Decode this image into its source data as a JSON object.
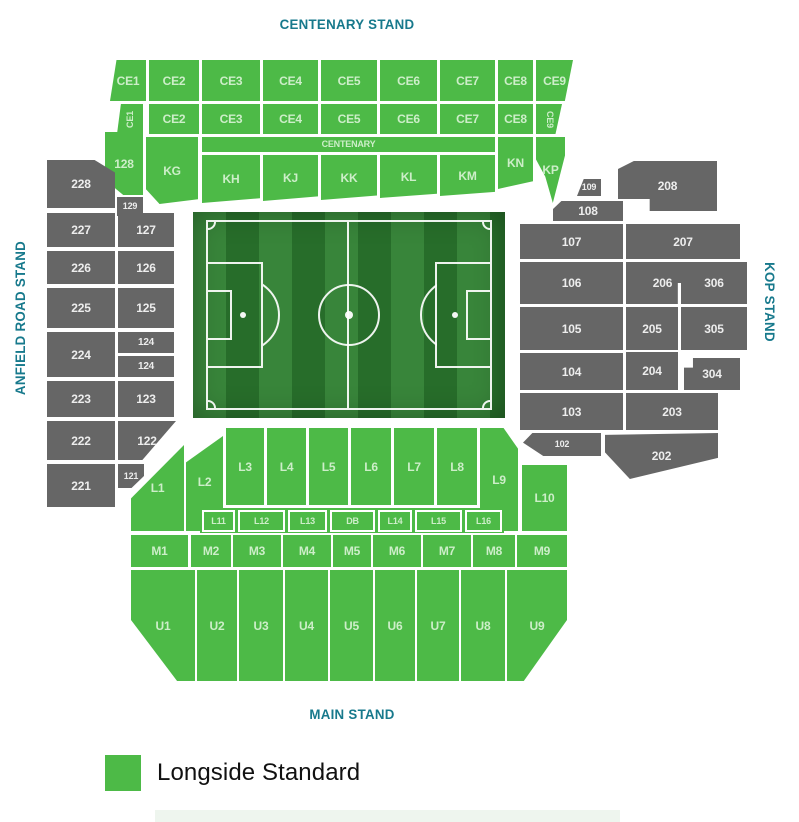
{
  "titles": {
    "centenary": "CENTENARY STAND",
    "anfield": "ANFIELD ROAD STAND",
    "kop": "KOP STAND",
    "main": "MAIN STAND"
  },
  "legend": {
    "label": "Longside Standard",
    "color": "#4dba47"
  },
  "colors": {
    "green": "#4dba47",
    "gray": "#666666",
    "teal": "#17798c",
    "pitch_light": "#38853a",
    "pitch_dark": "#276d2a",
    "line": "#ffffff"
  },
  "sections": [
    {
      "i": "CE1",
      "x": 110,
      "y": 60,
      "w": 36,
      "h": 41,
      "c": "18% 0,100% 0,100% 100%,0 100%"
    },
    {
      "i": "CE2",
      "x": 149,
      "y": 60,
      "w": 50,
      "h": 41
    },
    {
      "i": "CE3",
      "x": 202,
      "y": 60,
      "w": 58,
      "h": 41
    },
    {
      "i": "CE4",
      "x": 263,
      "y": 60,
      "w": 55,
      "h": 41
    },
    {
      "i": "CE5",
      "x": 321,
      "y": 60,
      "w": 56,
      "h": 41
    },
    {
      "i": "CE6",
      "x": 380,
      "y": 60,
      "w": 57,
      "h": 41
    },
    {
      "i": "CE7",
      "x": 440,
      "y": 60,
      "w": 55,
      "h": 41
    },
    {
      "i": "CE8",
      "x": 498,
      "y": 60,
      "w": 35,
      "h": 41
    },
    {
      "i": "CE9",
      "x": 536,
      "y": 60,
      "w": 37,
      "h": 41,
      "c": "0 0,100% 0,78% 100%,0 100%"
    },
    {
      "i": "CE1",
      "x": 117,
      "y": 104,
      "w": 26,
      "h": 30,
      "c": "15% 0,100% 0,100% 100%,0 100%",
      "r": -90,
      "f": 9
    },
    {
      "i": "CE2",
      "x": 149,
      "y": 104,
      "w": 50,
      "h": 30
    },
    {
      "i": "CE3",
      "x": 202,
      "y": 104,
      "w": 58,
      "h": 30
    },
    {
      "i": "CE4",
      "x": 263,
      "y": 104,
      "w": 55,
      "h": 30
    },
    {
      "i": "CE5",
      "x": 321,
      "y": 104,
      "w": 56,
      "h": 30
    },
    {
      "i": "CE6",
      "x": 380,
      "y": 104,
      "w": 57,
      "h": 30
    },
    {
      "i": "CE7",
      "x": 440,
      "y": 104,
      "w": 55,
      "h": 30
    },
    {
      "i": "CE8",
      "x": 498,
      "y": 104,
      "w": 35,
      "h": 30
    },
    {
      "i": "CE9",
      "x": 536,
      "y": 104,
      "w": 26,
      "h": 30,
      "c": "0 0,100% 0,75% 100%,0 100%",
      "r": 90,
      "f": 9
    },
    {
      "i": "CENTENARY",
      "x": 202,
      "y": 137,
      "w": 293,
      "h": 15,
      "f": 9
    },
    {
      "i": "128",
      "x": 105,
      "y": 132,
      "w": 38,
      "h": 63,
      "c": "0 0,100% 0,100% 100%,48% 100%,0 76%"
    },
    {
      "i": "KG",
      "x": 146,
      "y": 137,
      "w": 52,
      "h": 67,
      "c": "0 0,100% 0,100% 93%,26% 100%,0 78%"
    },
    {
      "i": "KH",
      "x": 202,
      "y": 155,
      "w": 58,
      "h": 48,
      "c": "0 0,100% 0,100% 90%,0 100%"
    },
    {
      "i": "KJ",
      "x": 263,
      "y": 155,
      "w": 55,
      "h": 46,
      "c": "0 0,100% 0,100% 90%,0 100%"
    },
    {
      "i": "KK",
      "x": 321,
      "y": 155,
      "w": 56,
      "h": 45,
      "c": "0 0,100% 0,100% 90%,0 100%"
    },
    {
      "i": "KL",
      "x": 380,
      "y": 155,
      "w": 57,
      "h": 43,
      "c": "0 0,100% 0,100% 90%,0 100%"
    },
    {
      "i": "KM",
      "x": 440,
      "y": 155,
      "w": 55,
      "h": 41,
      "c": "0 0,100% 0,100% 90%,0 100%"
    },
    {
      "i": "KN",
      "x": 498,
      "y": 137,
      "w": 35,
      "h": 52,
      "c": "0 0,100% 0,100% 85%,0 100%"
    },
    {
      "i": "KP",
      "x": 536,
      "y": 137,
      "w": 29,
      "h": 66,
      "c": "0 0,100% 0,100% 28%,58% 100%,32% 60%,0 34%"
    },
    {
      "i": "228",
      "x": 47,
      "y": 160,
      "w": 68,
      "h": 48,
      "v": "d",
      "c": "0 0,70% 0,100% 26%,100% 100%,0 100%"
    },
    {
      "i": "129",
      "x": 117,
      "y": 197,
      "w": 26,
      "h": 19,
      "v": "d",
      "f": 9
    },
    {
      "i": "227",
      "x": 47,
      "y": 213,
      "w": 68,
      "h": 34,
      "v": "d"
    },
    {
      "i": "127",
      "x": 118,
      "y": 213,
      "w": 56,
      "h": 34,
      "v": "d"
    },
    {
      "i": "226",
      "x": 47,
      "y": 251,
      "w": 68,
      "h": 33,
      "v": "d"
    },
    {
      "i": "126",
      "x": 118,
      "y": 251,
      "w": 56,
      "h": 33,
      "v": "d"
    },
    {
      "i": "225",
      "x": 47,
      "y": 288,
      "w": 68,
      "h": 40,
      "v": "d"
    },
    {
      "i": "125",
      "x": 118,
      "y": 288,
      "w": 56,
      "h": 40,
      "v": "d"
    },
    {
      "i": "224",
      "x": 47,
      "y": 332,
      "w": 68,
      "h": 45,
      "v": "d"
    },
    {
      "i": "124",
      "x": 118,
      "y": 332,
      "w": 56,
      "h": 21,
      "v": "d",
      "f": 10
    },
    {
      "i": "124",
      "x": 118,
      "y": 356,
      "w": 56,
      "h": 21,
      "v": "d",
      "f": 10
    },
    {
      "i": "223",
      "x": 47,
      "y": 381,
      "w": 68,
      "h": 36,
      "v": "d"
    },
    {
      "i": "123",
      "x": 118,
      "y": 381,
      "w": 56,
      "h": 36,
      "v": "d"
    },
    {
      "i": "222",
      "x": 47,
      "y": 421,
      "w": 68,
      "h": 39,
      "v": "d"
    },
    {
      "i": "122",
      "x": 118,
      "y": 421,
      "w": 58,
      "h": 39,
      "v": "d",
      "c": "0 0,100% 0,42% 100%,0 100%"
    },
    {
      "i": "221",
      "x": 47,
      "y": 464,
      "w": 68,
      "h": 43,
      "v": "d"
    },
    {
      "i": "121",
      "x": 118,
      "y": 464,
      "w": 26,
      "h": 24,
      "v": "d",
      "c": "0 0,100% 0,100% 50%,52% 100%,0 100%",
      "f": 9
    },
    {
      "i": "109",
      "x": 577,
      "y": 179,
      "w": 24,
      "h": 17,
      "v": "d",
      "c": "28% 0,100% 0,100% 100%,0 100%",
      "f": 9
    },
    {
      "i": "108",
      "x": 553,
      "y": 201,
      "w": 70,
      "h": 20,
      "v": "d",
      "c": "12% 0,100% 0,100% 100%,0 100%,0 40%"
    },
    {
      "i": "107",
      "x": 520,
      "y": 224,
      "w": 103,
      "h": 35,
      "v": "d"
    },
    {
      "i": "106",
      "x": 520,
      "y": 262,
      "w": 103,
      "h": 42,
      "v": "d"
    },
    {
      "i": "105",
      "x": 520,
      "y": 307,
      "w": 103,
      "h": 43,
      "v": "d"
    },
    {
      "i": "104",
      "x": 520,
      "y": 353,
      "w": 103,
      "h": 37,
      "v": "d"
    },
    {
      "i": "103",
      "x": 520,
      "y": 393,
      "w": 103,
      "h": 37,
      "v": "d"
    },
    {
      "i": "102",
      "x": 523,
      "y": 433,
      "w": 78,
      "h": 23,
      "v": "d",
      "c": "12% 0,100% 0,100% 100%,26% 100%,0 42%",
      "f": 9
    },
    {
      "i": "208",
      "x": 618,
      "y": 161,
      "w": 99,
      "h": 50,
      "v": "d",
      "c": "0 16%,16% 0,100% 0,100% 100%,32% 100%,32% 76%,0 76%"
    },
    {
      "i": "207",
      "x": 626,
      "y": 224,
      "w": 114,
      "h": 35,
      "v": "d"
    },
    {
      "i": "206",
      "x": 626,
      "y": 262,
      "w": 73,
      "h": 42,
      "v": "d",
      "c": "0 0,100% 0,100% 50%,71% 50%,71% 100%,0 100%"
    },
    {
      "i": "306",
      "x": 681,
      "y": 262,
      "w": 66,
      "h": 42,
      "v": "d",
      "c": "26% 0,100% 0,100% 100%,0 100%,0 48%,26% 48%"
    },
    {
      "i": "205",
      "x": 626,
      "y": 307,
      "w": 52,
      "h": 43,
      "v": "d"
    },
    {
      "i": "305",
      "x": 681,
      "y": 307,
      "w": 66,
      "h": 43,
      "v": "d"
    },
    {
      "i": "204",
      "x": 626,
      "y": 352,
      "w": 52,
      "h": 38,
      "v": "d"
    },
    {
      "i": "304",
      "x": 684,
      "y": 358,
      "w": 56,
      "h": 32,
      "v": "d",
      "c": "16% 0,100% 0,100% 100%,0 100%,0 30%,16% 30%"
    },
    {
      "i": "203",
      "x": 626,
      "y": 393,
      "w": 92,
      "h": 37,
      "v": "d"
    },
    {
      "i": "202",
      "x": 605,
      "y": 433,
      "w": 113,
      "h": 46,
      "v": "d",
      "c": "0 4%,100% 0,100% 54%,22% 100%,0 42%"
    },
    {
      "i": "L1",
      "x": 131,
      "y": 445,
      "w": 53,
      "h": 86,
      "c": "0 62%,100% 0,100% 100%,0 100%"
    },
    {
      "i": "L2",
      "x": 186,
      "y": 433,
      "w": 37,
      "h": 98,
      "c": "0 30%,100% 3%,100% 100%,0 100%"
    },
    {
      "i": "L3",
      "x": 226,
      "y": 428,
      "w": 38,
      "h": 77
    },
    {
      "i": "L4",
      "x": 267,
      "y": 428,
      "w": 39,
      "h": 77
    },
    {
      "i": "L5",
      "x": 309,
      "y": 428,
      "w": 39,
      "h": 77
    },
    {
      "i": "L6",
      "x": 351,
      "y": 428,
      "w": 40,
      "h": 77
    },
    {
      "i": "L7",
      "x": 394,
      "y": 428,
      "w": 40,
      "h": 77
    },
    {
      "i": "L8",
      "x": 437,
      "y": 428,
      "w": 40,
      "h": 77
    },
    {
      "i": "L9",
      "x": 480,
      "y": 428,
      "w": 38,
      "h": 103,
      "c": "0 0,62% 0,100% 20%,100% 100%,0 100%"
    },
    {
      "i": "L10",
      "x": 522,
      "y": 465,
      "w": 45,
      "h": 66
    },
    {
      "i": "",
      "x": 200,
      "y": 508,
      "w": 304,
      "h": 25,
      "v": "u"
    },
    {
      "i": "L11",
      "x": 202,
      "y": 510,
      "w": 33,
      "h": 22,
      "v": "o",
      "f": 9
    },
    {
      "i": "L12",
      "x": 238,
      "y": 510,
      "w": 47,
      "h": 22,
      "v": "o",
      "f": 9
    },
    {
      "i": "L13",
      "x": 288,
      "y": 510,
      "w": 39,
      "h": 22,
      "v": "o",
      "f": 9
    },
    {
      "i": "DB",
      "x": 330,
      "y": 510,
      "w": 45,
      "h": 22,
      "v": "o",
      "f": 9
    },
    {
      "i": "L14",
      "x": 378,
      "y": 510,
      "w": 34,
      "h": 22,
      "v": "o",
      "f": 9
    },
    {
      "i": "L15",
      "x": 415,
      "y": 510,
      "w": 47,
      "h": 22,
      "v": "o",
      "f": 9
    },
    {
      "i": "L16",
      "x": 465,
      "y": 510,
      "w": 37,
      "h": 22,
      "v": "o",
      "f": 9
    },
    {
      "i": "M1",
      "x": 131,
      "y": 535,
      "w": 57,
      "h": 32
    },
    {
      "i": "M2",
      "x": 191,
      "y": 535,
      "w": 40,
      "h": 32
    },
    {
      "i": "M3",
      "x": 233,
      "y": 535,
      "w": 48,
      "h": 32
    },
    {
      "i": "M4",
      "x": 283,
      "y": 535,
      "w": 48,
      "h": 32
    },
    {
      "i": "M5",
      "x": 333,
      "y": 535,
      "w": 38,
      "h": 32
    },
    {
      "i": "M6",
      "x": 373,
      "y": 535,
      "w": 48,
      "h": 32
    },
    {
      "i": "M7",
      "x": 423,
      "y": 535,
      "w": 48,
      "h": 32
    },
    {
      "i": "M8",
      "x": 473,
      "y": 535,
      "w": 42,
      "h": 32
    },
    {
      "i": "M9",
      "x": 517,
      "y": 535,
      "w": 50,
      "h": 32
    },
    {
      "i": "U1",
      "x": 131,
      "y": 570,
      "w": 64,
      "h": 111,
      "c": "0 0,100% 0,100% 100%,72% 100%,0 45%"
    },
    {
      "i": "U2",
      "x": 197,
      "y": 570,
      "w": 40,
      "h": 111
    },
    {
      "i": "U3",
      "x": 239,
      "y": 570,
      "w": 44,
      "h": 111
    },
    {
      "i": "U4",
      "x": 285,
      "y": 570,
      "w": 43,
      "h": 111
    },
    {
      "i": "U5",
      "x": 330,
      "y": 570,
      "w": 43,
      "h": 111
    },
    {
      "i": "U6",
      "x": 375,
      "y": 570,
      "w": 40,
      "h": 111
    },
    {
      "i": "U7",
      "x": 417,
      "y": 570,
      "w": 42,
      "h": 111
    },
    {
      "i": "U8",
      "x": 461,
      "y": 570,
      "w": 44,
      "h": 111
    },
    {
      "i": "U9",
      "x": 507,
      "y": 570,
      "w": 60,
      "h": 111,
      "c": "0 0,100% 0,100% 45%,28% 100%,0 100%"
    }
  ]
}
